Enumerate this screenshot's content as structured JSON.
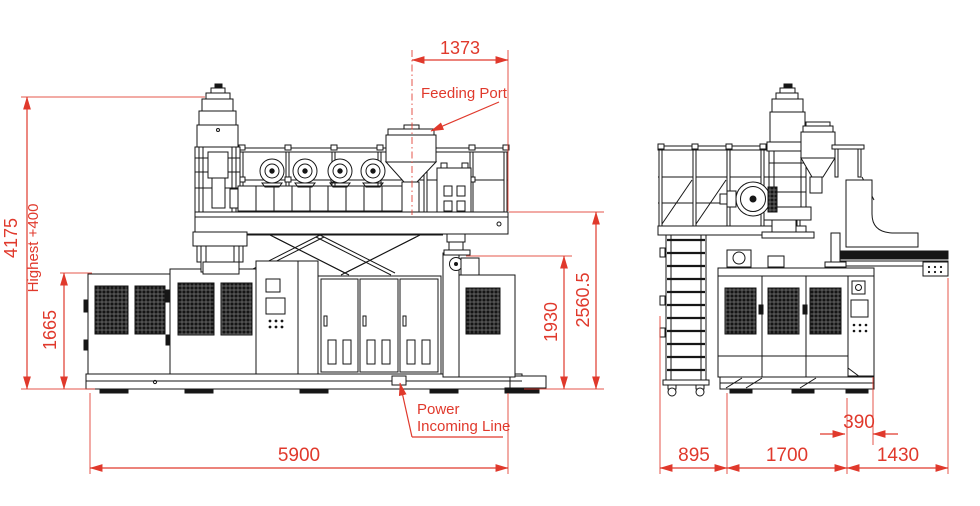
{
  "colors": {
    "dimension_red": "#e0392c",
    "line_black": "#161616",
    "background": "#ffffff"
  },
  "front_view": {
    "dims": {
      "feed_width": "1373",
      "overall_height": "4175",
      "height_note": "Highest +400",
      "cabinet_height": "1665",
      "body_height": "1930",
      "platform_height": "2560.5",
      "overall_length": "5900"
    },
    "labels": {
      "feeding_port": "Feeding Port",
      "power_line_1": "Power",
      "power_line_2": "Incoming Line"
    }
  },
  "side_view": {
    "dims": {
      "ladder_depth": "895",
      "body_depth": "1700",
      "conveyor_depth": "1430",
      "offset": "390"
    }
  }
}
